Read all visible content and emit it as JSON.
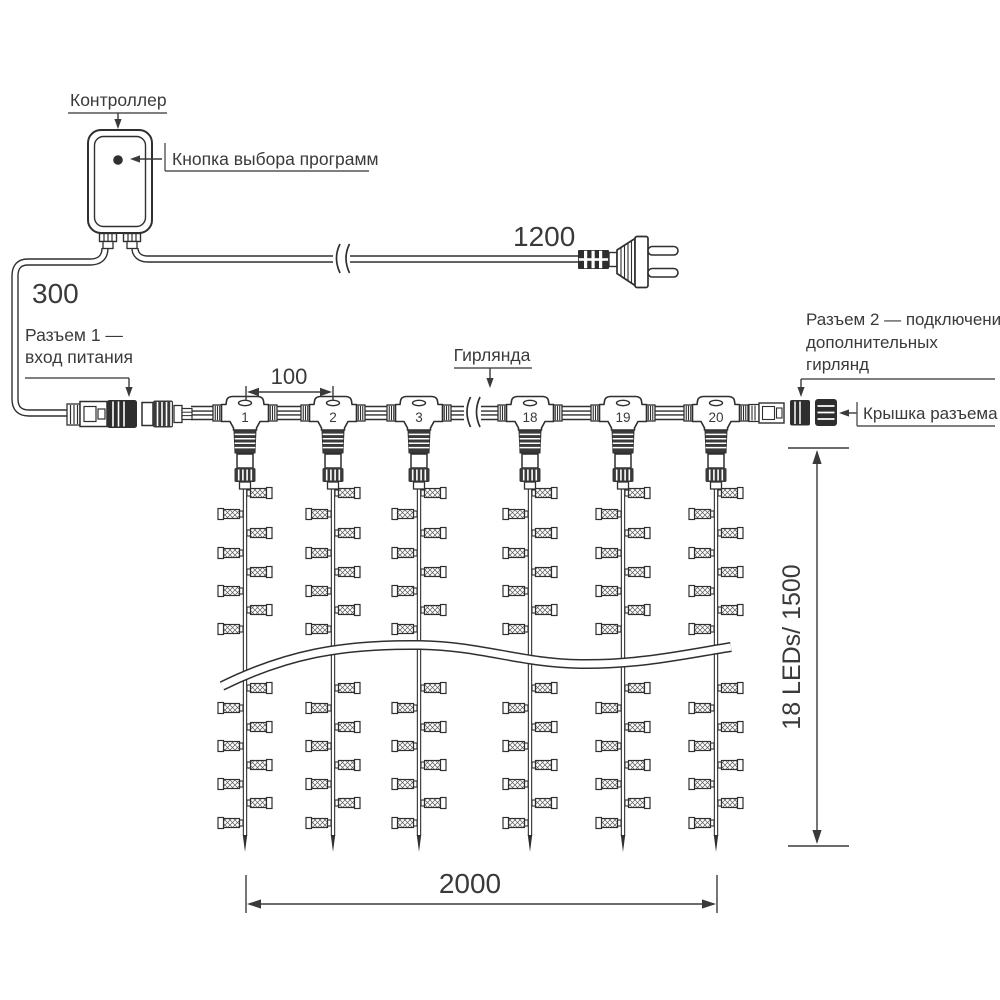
{
  "diagram": {
    "labels": {
      "controller": "Контроллер",
      "program_button": "Кнопка выбора программ",
      "garland": "Гирлянда",
      "connector1_line1": "Разъем 1 —",
      "connector1_line2": "вход питания",
      "connector2_line1": "Разъем 2 — подключение",
      "connector2_line2": "дополнительных",
      "connector2_line3": "гирлянд",
      "connector_cap": "Крышка разъема"
    },
    "dimensions": {
      "power_cable": "1200",
      "input_cable": "300",
      "drop_spacing": "100",
      "curtain_width": "2000",
      "curtain_height": "18 LEDs/ 1500"
    },
    "drop_numbers": [
      "1",
      "2",
      "3",
      "18",
      "19",
      "20"
    ]
  }
}
